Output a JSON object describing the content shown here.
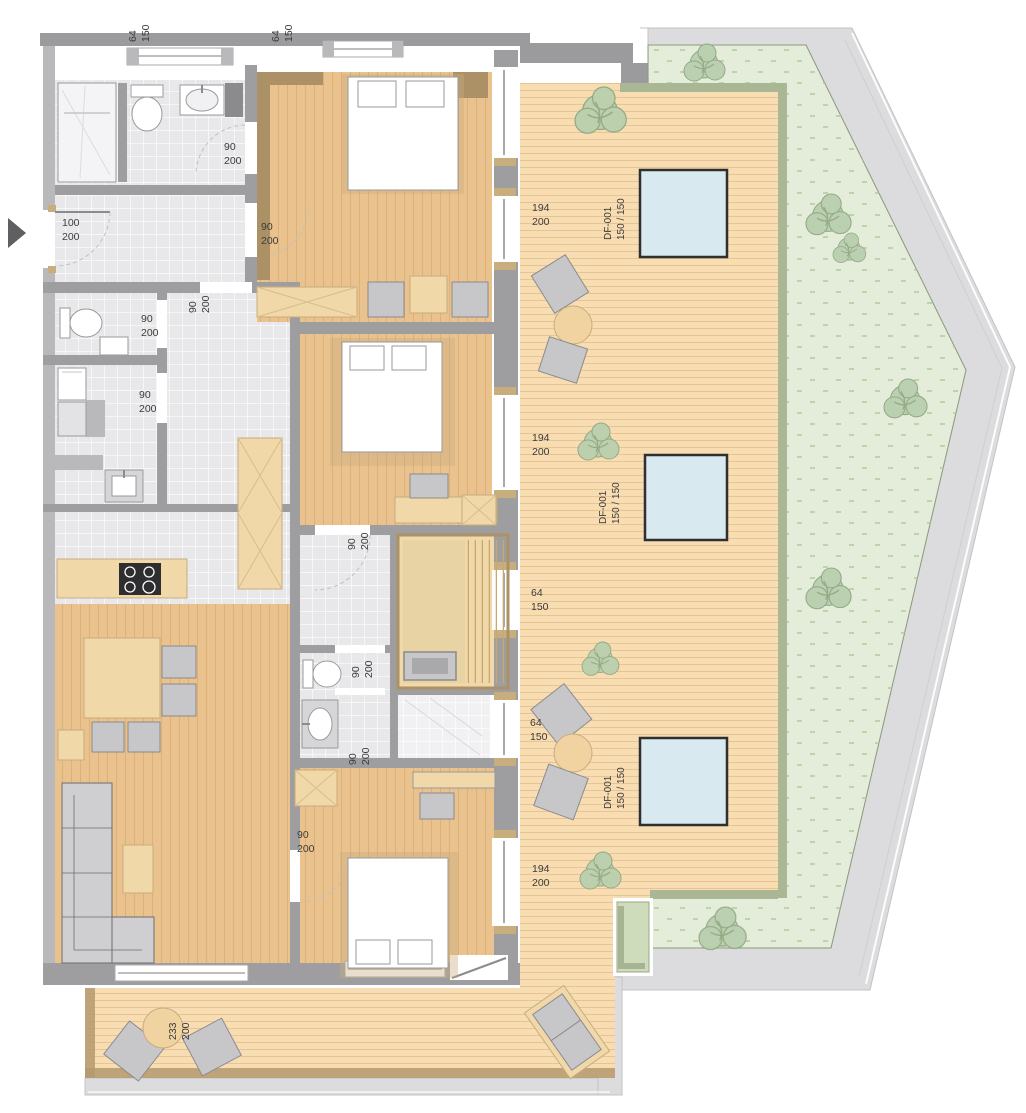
{
  "plan": {
    "type": "apartment-floor-plan-with-roof-terrace",
    "colors": {
      "deck": "#f8dcb2",
      "deck_line": "#e7c494",
      "wood": "#eac28e",
      "wood_line": "#d9ab74",
      "furniture_wood": "#f1d8a9",
      "trim_brown": "#ac9166",
      "wall": "#9e9ea0",
      "wall_light": "#b9b9bb",
      "wall_dark": "#8b8b8d",
      "tile": "#e8e8ea",
      "shower_tile": "#f1f1f3",
      "eave": "#dcdcde",
      "band": "#9b9b9d",
      "green_roof": "#e4edda",
      "green_dot": "#b4cba0",
      "hedge": "#a9b795",
      "skylight": "#d9e9f0",
      "skylight_frame": "#2f2f2f",
      "gray_furniture": "#c7c7c9",
      "planter": "#cfdcbc",
      "arrow": "#5f5f61",
      "text": "#3b3b3b"
    }
  },
  "dim_labels": [
    {
      "line1": "64",
      "line2": "150",
      "at": "top-window-1"
    },
    {
      "line1": "64",
      "line2": "150",
      "at": "top-window-2"
    },
    {
      "line1": "90",
      "line2": "200",
      "at": "bathroom-1-door"
    },
    {
      "line1": "100",
      "line2": "200",
      "at": "entrance-door"
    },
    {
      "line1": "90",
      "line2": "200",
      "at": "bedroom-1-door"
    },
    {
      "line1": "90",
      "line2": "200",
      "at": "corridor-door"
    },
    {
      "line1": "90",
      "line2": "200",
      "at": "bathroom-2-door"
    },
    {
      "line1": "90",
      "line2": "200",
      "at": "utility-door"
    },
    {
      "line1": "90",
      "line2": "200",
      "at": "bedroom-2-door"
    },
    {
      "line1": "90",
      "line2": "200",
      "at": "bathroom-3-door"
    },
    {
      "line1": "90",
      "line2": "200",
      "at": "shower-room-door"
    },
    {
      "line1": "90",
      "line2": "200",
      "at": "bedroom-3-door"
    },
    {
      "line1": "194",
      "line2": "200",
      "at": "terrace-door-1"
    },
    {
      "line1": "194",
      "line2": "200",
      "at": "terrace-door-2"
    },
    {
      "line1": "64",
      "line2": "150",
      "at": "terrace-window-1"
    },
    {
      "line1": "64",
      "line2": "150",
      "at": "terrace-window-2"
    },
    {
      "line1": "194",
      "line2": "200",
      "at": "terrace-door-3"
    },
    {
      "line1": "233",
      "line2": "200",
      "at": "balcony-door"
    }
  ],
  "skylights": [
    {
      "code": "DF-001",
      "size": "150 / 150"
    },
    {
      "code": "DF-001",
      "size": "150 / 150"
    },
    {
      "code": "DF-001",
      "size": "150 / 150"
    }
  ]
}
